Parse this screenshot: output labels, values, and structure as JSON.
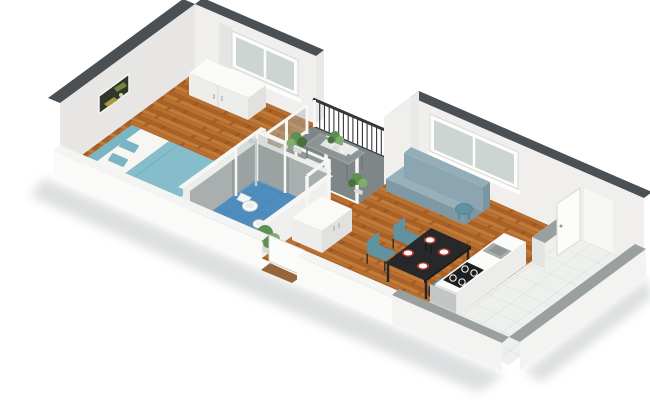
{
  "scene": {
    "kind": "isometric-3d-floor-plan-render",
    "background": "#ffffff"
  },
  "rooms": [
    {
      "name": "bedroom"
    },
    {
      "name": "bathroom"
    },
    {
      "name": "balcony"
    },
    {
      "name": "hallway"
    },
    {
      "name": "living-room"
    },
    {
      "name": "kitchen"
    }
  ],
  "furniture": [
    "double-bed",
    "pillows",
    "duvet",
    "wardrobe",
    "wall-picture",
    "bedroom-window",
    "shower",
    "shower-column",
    "toilet",
    "bidet",
    "hallway-cabinet",
    "bathroom-door-frame",
    "balcony-railing",
    "balcony-glazing",
    "balcony-door-frame",
    "balcony-table",
    "seat-cushions",
    "potted-plants",
    "sofa",
    "living-window",
    "side-stool",
    "dining-table",
    "dining-chairs",
    "plates",
    "candles",
    "kitchen-counter",
    "kitchen-sink",
    "cooktop",
    "gray-armchair",
    "kitchen-divider-wall",
    "open-door",
    "entrance-door",
    "doormat",
    "hallway-plant"
  ],
  "colors": {
    "background": "#ffffff",
    "wallTop": "#4b5055",
    "wallFace": "#f0efed",
    "wallFaceSide": "#e7e6e4",
    "wallEndCap": "#e9e9e7",
    "extFace": "#fafaf9",
    "cutTop": "#f4f4f2",
    "annexTop": "#9aa09d",
    "annexFace": "#f3f3f1",
    "woodBase": "#b96f2f",
    "woodDark": "#aa6126",
    "woodLight": "#c07b38",
    "woodLine": "#8a4c1c",
    "tileWhite": "#eef0ee",
    "tileLine": "#d8dcd9",
    "bathBlue": "#4f8dbe",
    "bathBlueLine": "#4379a6",
    "bathWallTile": "#a9aeae",
    "showerTile": "#969d9d",
    "glass": "#aab3b0",
    "chrome": "#c3c9cc",
    "teal": "#7ab5c5",
    "duvet": "#86bdcb",
    "tealDark": "#5f93a2",
    "bedFrame": "#f2f1ee",
    "bedSide": "#e8e6e2",
    "linenWhite": "#f7f6f3",
    "sofaBack": "#8ba6b1",
    "sofaSeat": "#97b1ba",
    "sofaFront": "#7f99a4",
    "sofaEnd": "#7b96a1",
    "sofaTop": "#93aeb8",
    "tableBlack": "#26282a",
    "tableEdge": "#1b1d1f",
    "plateRed": "#b7342d",
    "plateWhite": "#fdfdfc",
    "railing": "#34383b",
    "balconyFloor": "#7f8687",
    "balconyTable": "#8d9495",
    "cushionWhite": "#eceeec",
    "green": "#5f8f52",
    "greenDark": "#49713d",
    "greenLight": "#7fae6a",
    "potGray": "#d8dcd9",
    "counter": "#fbfbf9",
    "counterSide": "#ececea",
    "counterFront": "#e4e4e2",
    "sinkGray": "#a9aeac",
    "sinkInner": "#8f9693",
    "cooktop": "#1c1e20",
    "burnerRing": "#e8e8e6",
    "grayChair": "#c2c6c4",
    "grayChairSeat": "#cdd1cf",
    "grayChairFront": "#b5b9b7",
    "mat": "#96653a",
    "furnWhiteTop": "#fafaf8",
    "furnWhiteFront": "#ededeb",
    "furnWhiteSide": "#e1e1df",
    "frameWhite": "#f6f6f4",
    "doorWhite": "#fcfcfa",
    "doorStroke": "#d8d8d6",
    "windowGlass": "#ccd5d1",
    "windowFrame": "#fdfdfc",
    "curtain": "#e3e3e1",
    "pictureBg": "#30372a",
    "pictureYellow": "#b2a43d",
    "pictureGreen": "#77843f",
    "pictureDot": "#d8d2a0",
    "bathTopStrip": "#eceeec",
    "shadow": "#a6abae",
    "handleGray": "#b9b9b7",
    "tealStroke": "#69abc0",
    "stoolStroke": "#538494",
    "legDark": "#2a2c2e"
  }
}
